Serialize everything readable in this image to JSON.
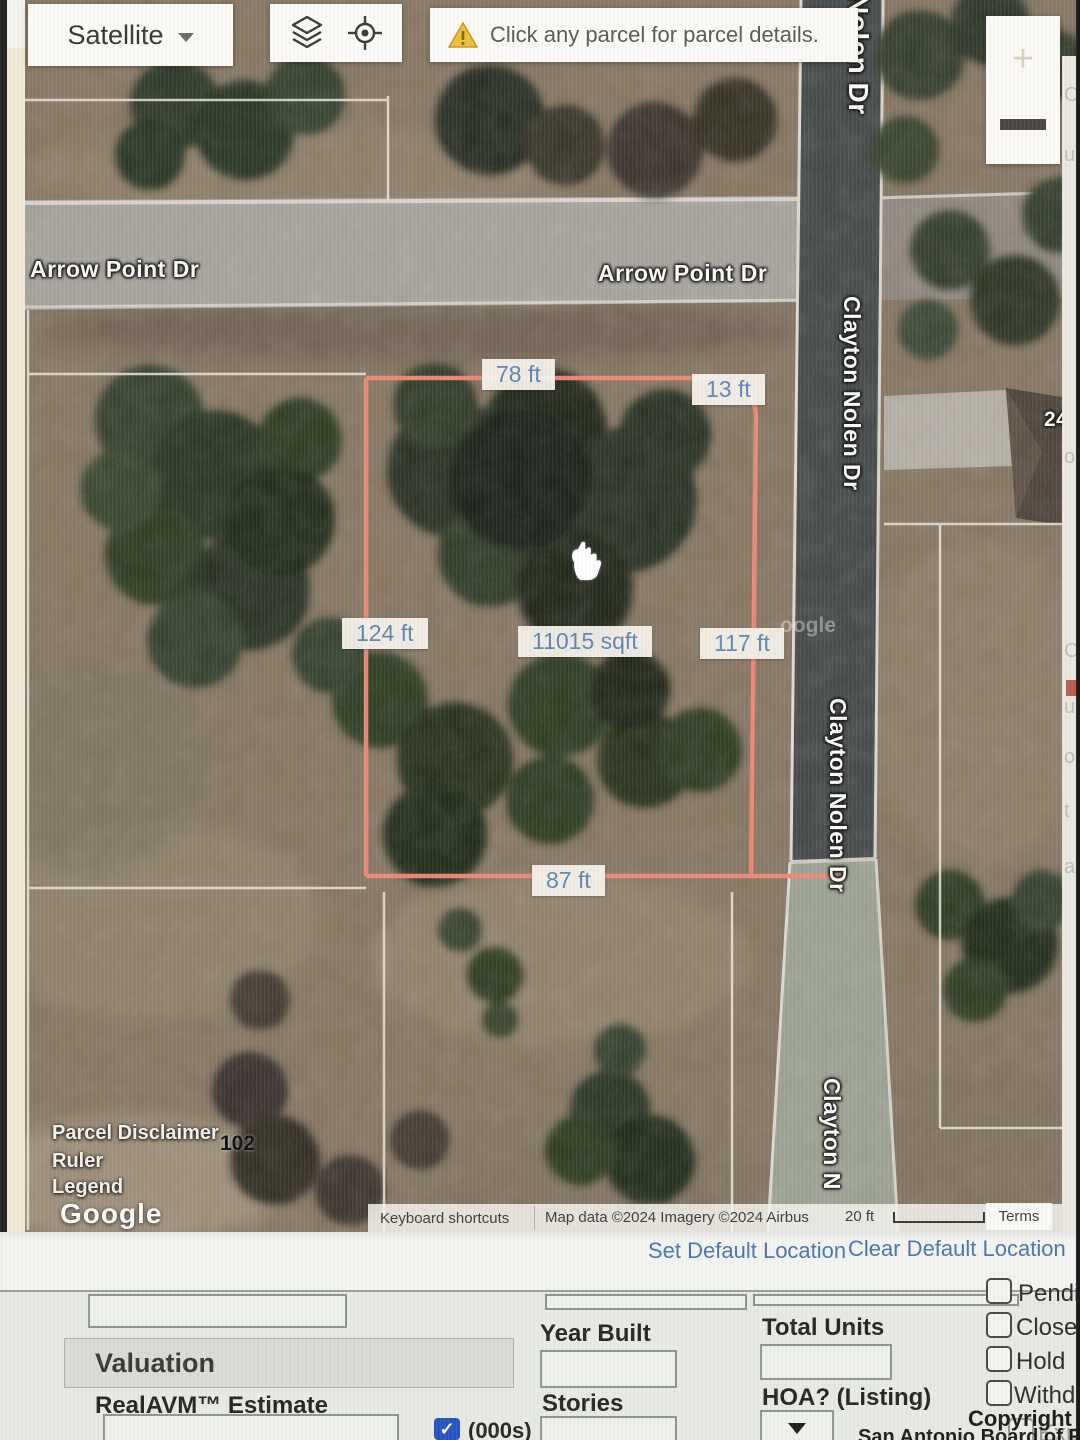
{
  "map": {
    "satellite_button": {
      "label": "Satellite"
    },
    "warning": {
      "text": "Click any parcel for parcel details."
    },
    "street_labels": {
      "arrow_point_left": "Arrow Point Dr",
      "arrow_point_right": "Arrow Point Dr",
      "nolen_top": "Nolen Dr",
      "clayton_mid": "Clayton Nolen Dr",
      "clayton_lower": "Clayton Nolen Dr",
      "clayton_bottom_partial": "Clayton N"
    },
    "measurements": {
      "top_edge": "78 ft",
      "ne_corner": "13 ft",
      "west_edge": "124 ft",
      "area": "11015 sqft",
      "east_edge": "117 ft",
      "south_edge": "87 ft"
    },
    "parcel_number": "102",
    "house_number": "240",
    "watermark_partial": "oogle",
    "google_logo": "Google",
    "overlay_links": [
      "Parcel Disclaimer",
      "Ruler",
      "Legend"
    ],
    "attribution": {
      "keyboard": "Keyboard shortcuts",
      "map_data": "Map data ©2024 Imagery ©2024 Airbus",
      "scale_label": "20 ft",
      "terms": "Terms"
    },
    "right_edge_fragments": [
      "C",
      "u",
      "o",
      "C",
      "u",
      "o",
      "t",
      "a"
    ]
  },
  "actions": {
    "set_default": "Set Default Location",
    "clear_default": "Clear Default Location"
  },
  "form": {
    "valuation_header": "Valuation",
    "realavm_label": "RealAVM™ Estimate",
    "realavm_value": "",
    "thousands_label": "(000s)",
    "thousands_checked": true,
    "year_built_label": "Year Built",
    "year_built_value": "",
    "stories_label": "Stories",
    "stories_value": "",
    "total_units_label": "Total Units",
    "total_units_value": "",
    "hoa_label": "HOA? (Listing)",
    "hoa_selected_value": "",
    "status_checkboxes": [
      {
        "label": "Pending",
        "checked": false
      },
      {
        "label": "Closed",
        "checked": false
      },
      {
        "label": "Hold",
        "checked": false
      },
      {
        "label": "Withdrawn",
        "checked": false
      },
      {
        "label": "Expired",
        "checked": false
      }
    ]
  },
  "footer": {
    "copyright": "Copyright 2025",
    "organization": "San Antonio Board of Realtors®"
  },
  "colors": {
    "parcel_outline": "#ef8a77",
    "measurement_text": "#5f88b4",
    "link_blue": "#4b76b0",
    "warning_yellow": "#eebf3f",
    "checkbox_blue": "#2653c4"
  }
}
